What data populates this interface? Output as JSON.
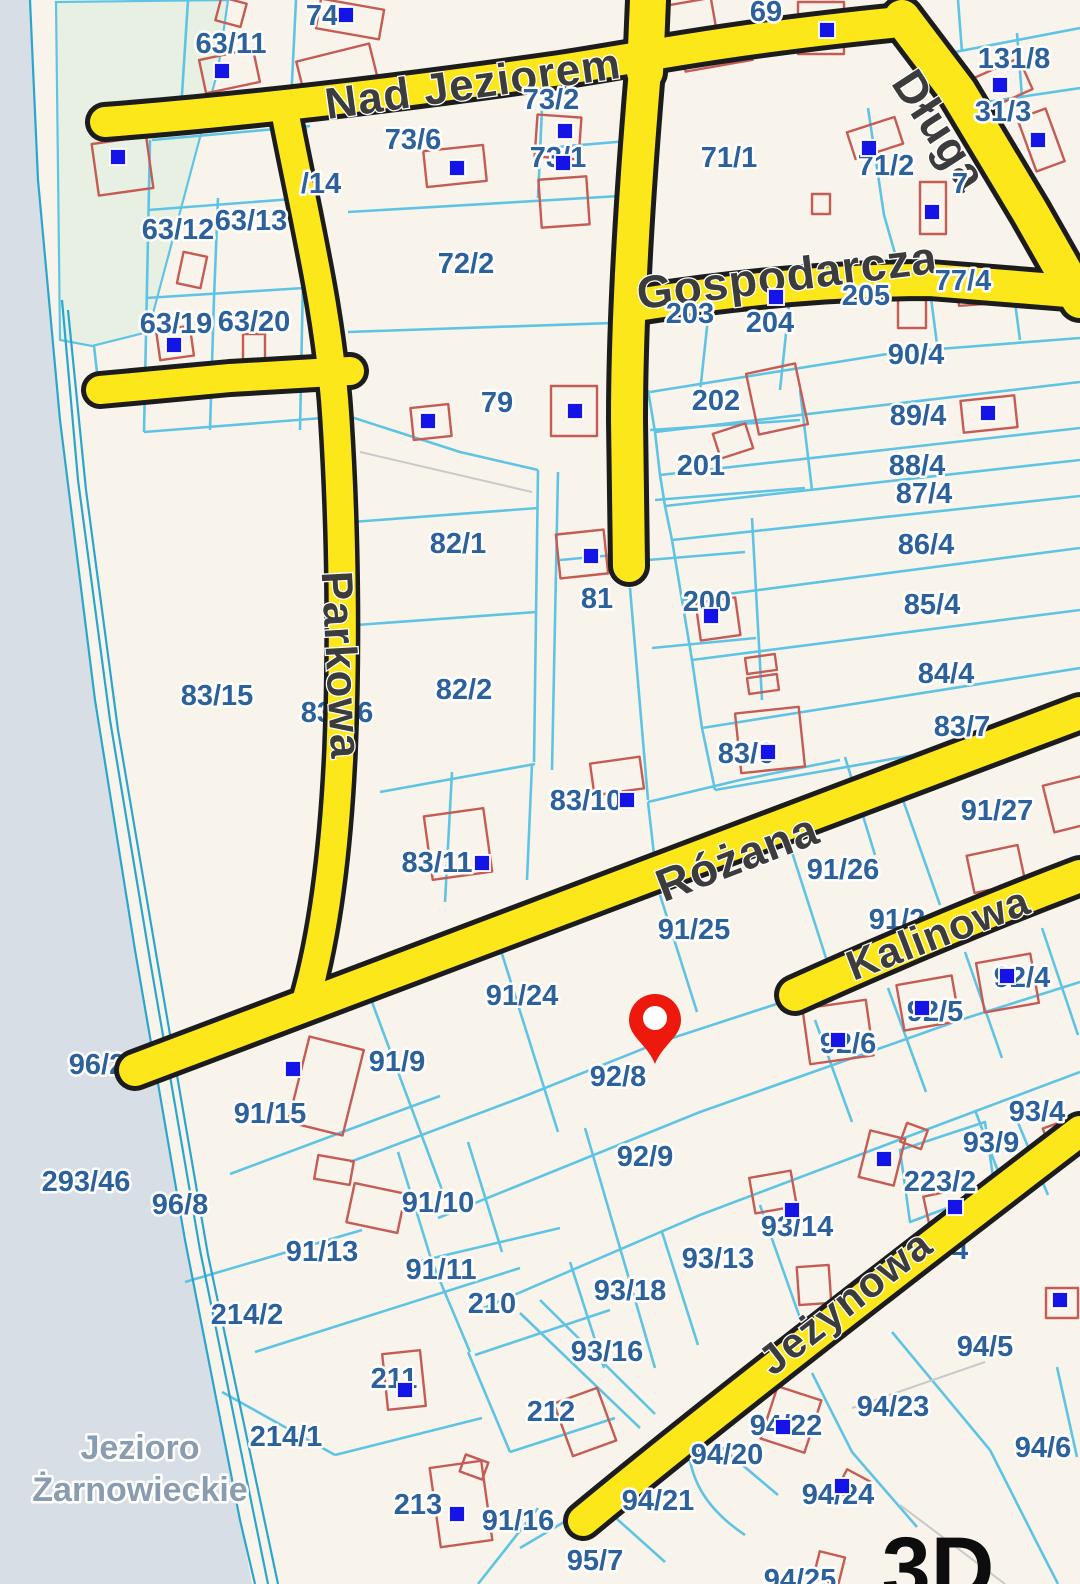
{
  "map": {
    "colors": {
      "land": "#f8f4ec",
      "water": "#d7dee5",
      "green": "#e7f0e3",
      "road_casing": "#1c1c1c",
      "road_fill": "#fce81a",
      "boundary": "#5fc4e4",
      "boundary_strong": "#2aa6cc",
      "building": "#c45c55",
      "marker": "#1414e6",
      "parcel_text": "#2d619b",
      "street_text": "#3c3c3c",
      "water_text": "#8a9cb0",
      "pin": "#ed190d"
    },
    "streets": [
      {
        "name": "Nad Jeziorem",
        "x": 473,
        "y": 84,
        "rotation": -8,
        "size": 44
      },
      {
        "name": "Długa",
        "x": 940,
        "y": 130,
        "rotation": 57,
        "size": 46
      },
      {
        "name": "Gospodarcza",
        "x": 787,
        "y": 275,
        "rotation": -7,
        "size": 46
      },
      {
        "name": "Parkowa",
        "x": 341,
        "y": 665,
        "rotation": 87,
        "size": 44
      },
      {
        "name": "Różana",
        "x": 737,
        "y": 857,
        "rotation": -21,
        "size": 46
      },
      {
        "name": "Kalinowa",
        "x": 938,
        "y": 933,
        "rotation": -21,
        "size": 42
      },
      {
        "name": "Jeżynowa",
        "x": 845,
        "y": 1302,
        "rotation": -38,
        "size": 42
      }
    ],
    "water_label_line1": "Jezioro",
    "water_label_line2": "Żarnowieckie",
    "view3d_label": "3D",
    "pin": {
      "x": 655,
      "y": 1064
    },
    "parcels": [
      {
        "label": "74",
        "x": 322,
        "y": 16
      },
      {
        "label": "69",
        "x": 766,
        "y": 12
      },
      {
        "label": "63/11",
        "x": 231,
        "y": 44
      },
      {
        "label": "73/2",
        "x": 551,
        "y": 100
      },
      {
        "label": "131/8",
        "x": 1014,
        "y": 59
      },
      {
        "label": "31/3",
        "x": 1003,
        "y": 112
      },
      {
        "label": "1",
        "x": 965,
        "y": 77,
        "under": true
      },
      {
        "label": "73/6",
        "x": 413,
        "y": 140
      },
      {
        "label": "73/1",
        "x": 558,
        "y": 158
      },
      {
        "label": "71/1",
        "x": 729,
        "y": 158
      },
      {
        "label": "71/2",
        "x": 886,
        "y": 166
      },
      {
        "label": "7",
        "x": 960,
        "y": 184
      },
      {
        "label": "/14",
        "x": 321,
        "y": 184
      },
      {
        "label": "63/12",
        "x": 178,
        "y": 230
      },
      {
        "label": "63/13",
        "x": 251,
        "y": 221
      },
      {
        "label": "72/2",
        "x": 466,
        "y": 264
      },
      {
        "label": "63/19",
        "x": 176,
        "y": 324
      },
      {
        "label": "63/20",
        "x": 254,
        "y": 322
      },
      {
        "label": "203",
        "x": 690,
        "y": 314
      },
      {
        "label": "204",
        "x": 770,
        "y": 323
      },
      {
        "label": "205",
        "x": 866,
        "y": 296
      },
      {
        "label": "77/4",
        "x": 963,
        "y": 281
      },
      {
        "label": "90/4",
        "x": 916,
        "y": 355
      },
      {
        "label": "79",
        "x": 497,
        "y": 403
      },
      {
        "label": "202",
        "x": 716,
        "y": 401
      },
      {
        "label": "89/4",
        "x": 918,
        "y": 416
      },
      {
        "label": "201",
        "x": 701,
        "y": 466
      },
      {
        "label": "88/4",
        "x": 917,
        "y": 466
      },
      {
        "label": "87/4",
        "x": 924,
        "y": 494
      },
      {
        "label": "82/1",
        "x": 458,
        "y": 544
      },
      {
        "label": "86/4",
        "x": 926,
        "y": 545
      },
      {
        "label": "81",
        "x": 597,
        "y": 599
      },
      {
        "label": "200",
        "x": 707,
        "y": 602
      },
      {
        "label": "85/4",
        "x": 932,
        "y": 605
      },
      {
        "label": "84/4",
        "x": 946,
        "y": 674
      },
      {
        "label": "83/15",
        "x": 217,
        "y": 696
      },
      {
        "label": "83/16",
        "x": 337,
        "y": 713,
        "under": true
      },
      {
        "label": "82/2",
        "x": 464,
        "y": 690
      },
      {
        "label": "83/7",
        "x": 962,
        "y": 727
      },
      {
        "label": "83/6",
        "x": 746,
        "y": 754
      },
      {
        "label": "83/10",
        "x": 586,
        "y": 801
      },
      {
        "label": "91/27",
        "x": 997,
        "y": 811
      },
      {
        "label": "83/11",
        "x": 437,
        "y": 863
      },
      {
        "label": "91/26",
        "x": 843,
        "y": 870
      },
      {
        "label": "91/2",
        "x": 897,
        "y": 920,
        "under": true
      },
      {
        "label": "91/25",
        "x": 694,
        "y": 930
      },
      {
        "label": "91/24",
        "x": 522,
        "y": 996
      },
      {
        "label": "92/4",
        "x": 1022,
        "y": 978
      },
      {
        "label": "96/2",
        "x": 97,
        "y": 1065,
        "under": true
      },
      {
        "label": "92/5",
        "x": 935,
        "y": 1012
      },
      {
        "label": "92/8",
        "x": 618,
        "y": 1077
      },
      {
        "label": "92/6",
        "x": 848,
        "y": 1044
      },
      {
        "label": "91/15",
        "x": 270,
        "y": 1114
      },
      {
        "label": "91/9",
        "x": 397,
        "y": 1062
      },
      {
        "label": "293/46",
        "x": 86,
        "y": 1182
      },
      {
        "label": "96/8",
        "x": 180,
        "y": 1205
      },
      {
        "label": "92/9",
        "x": 645,
        "y": 1157
      },
      {
        "label": "93/4",
        "x": 1037,
        "y": 1112
      },
      {
        "label": "93/9",
        "x": 991,
        "y": 1143
      },
      {
        "label": "223/2",
        "x": 940,
        "y": 1182
      },
      {
        "label": "91/10",
        "x": 438,
        "y": 1203
      },
      {
        "label": "93/14",
        "x": 797,
        "y": 1227
      },
      {
        "label": "91/13",
        "x": 322,
        "y": 1252
      },
      {
        "label": "93/13",
        "x": 718,
        "y": 1259
      },
      {
        "label": "91/11",
        "x": 441,
        "y": 1270
      },
      {
        "label": "210",
        "x": 492,
        "y": 1304
      },
      {
        "label": "214/2",
        "x": 247,
        "y": 1315
      },
      {
        "label": "93/18",
        "x": 630,
        "y": 1291
      },
      {
        "label": "94",
        "x": 952,
        "y": 1250,
        "under": true
      },
      {
        "label": "93/16",
        "x": 607,
        "y": 1352
      },
      {
        "label": "211",
        "x": 394,
        "y": 1379
      },
      {
        "label": "94/5",
        "x": 985,
        "y": 1347
      },
      {
        "label": "212",
        "x": 551,
        "y": 1412
      },
      {
        "label": "94/23",
        "x": 893,
        "y": 1407
      },
      {
        "label": "94/22",
        "x": 786,
        "y": 1426
      },
      {
        "label": "214/1",
        "x": 286,
        "y": 1437
      },
      {
        "label": "94/20",
        "x": 727,
        "y": 1455
      },
      {
        "label": "94/6",
        "x": 1043,
        "y": 1448
      },
      {
        "label": "213",
        "x": 418,
        "y": 1505
      },
      {
        "label": "91/16",
        "x": 518,
        "y": 1521,
        "under": true
      },
      {
        "label": "94/21",
        "x": 658,
        "y": 1501
      },
      {
        "label": "94/24",
        "x": 838,
        "y": 1495
      },
      {
        "label": "95/7",
        "x": 595,
        "y": 1561
      },
      {
        "label": "94/25",
        "x": 800,
        "y": 1580
      }
    ],
    "buildings": [
      {
        "x": 318,
        "y": 4,
        "w": 64,
        "h": 30,
        "r": 10
      },
      {
        "x": 218,
        "y": 0,
        "w": 26,
        "h": 24,
        "r": 15
      },
      {
        "x": 202,
        "y": 54,
        "w": 55,
        "h": 34,
        "r": -12
      },
      {
        "x": 640,
        "y": 4,
        "w": 75,
        "h": 42,
        "r": -10
      },
      {
        "x": 682,
        "y": 30,
        "w": 68,
        "h": 36,
        "r": -10
      },
      {
        "x": 798,
        "y": 2,
        "w": 46,
        "h": 52,
        "r": 0
      },
      {
        "x": 300,
        "y": 52,
        "w": 75,
        "h": 40,
        "r": -14
      },
      {
        "x": 95,
        "y": 140,
        "w": 55,
        "h": 52,
        "r": -8
      },
      {
        "x": 425,
        "y": 148,
        "w": 60,
        "h": 36,
        "r": -6
      },
      {
        "x": 536,
        "y": 116,
        "w": 44,
        "h": 42,
        "r": 4
      },
      {
        "x": 540,
        "y": 178,
        "w": 48,
        "h": 48,
        "r": -4
      },
      {
        "x": 850,
        "y": 124,
        "w": 50,
        "h": 28,
        "r": -18
      },
      {
        "x": 972,
        "y": 68,
        "w": 56,
        "h": 34,
        "r": -24
      },
      {
        "x": 1026,
        "y": 112,
        "w": 30,
        "h": 56,
        "r": -20
      },
      {
        "x": 920,
        "y": 182,
        "w": 26,
        "h": 52,
        "r": 0
      },
      {
        "x": 812,
        "y": 194,
        "w": 18,
        "h": 20,
        "r": 0
      },
      {
        "x": 644,
        "y": 302,
        "w": 24,
        "h": 20,
        "r": -8
      },
      {
        "x": 898,
        "y": 292,
        "w": 28,
        "h": 36,
        "r": 0
      },
      {
        "x": 958,
        "y": 276,
        "w": 54,
        "h": 28,
        "r": -4
      },
      {
        "x": 752,
        "y": 368,
        "w": 50,
        "h": 62,
        "r": -12
      },
      {
        "x": 716,
        "y": 428,
        "w": 34,
        "h": 26,
        "r": -18
      },
      {
        "x": 962,
        "y": 398,
        "w": 54,
        "h": 32,
        "r": -6
      },
      {
        "x": 180,
        "y": 254,
        "w": 24,
        "h": 32,
        "r": 12
      },
      {
        "x": 158,
        "y": 328,
        "w": 34,
        "h": 30,
        "r": -8
      },
      {
        "x": 243,
        "y": 334,
        "w": 22,
        "h": 28,
        "r": 0
      },
      {
        "x": 412,
        "y": 406,
        "w": 38,
        "h": 32,
        "r": -6
      },
      {
        "x": 551,
        "y": 386,
        "w": 46,
        "h": 50,
        "r": 0
      },
      {
        "x": 558,
        "y": 532,
        "w": 48,
        "h": 44,
        "r": -6
      },
      {
        "x": 698,
        "y": 600,
        "w": 40,
        "h": 38,
        "r": -8
      },
      {
        "x": 746,
        "y": 656,
        "w": 30,
        "h": 16,
        "r": -8
      },
      {
        "x": 748,
        "y": 676,
        "w": 30,
        "h": 16,
        "r": -8
      },
      {
        "x": 738,
        "y": 710,
        "w": 64,
        "h": 60,
        "r": -6
      },
      {
        "x": 592,
        "y": 760,
        "w": 50,
        "h": 32,
        "r": -8
      },
      {
        "x": 428,
        "y": 812,
        "w": 60,
        "h": 64,
        "r": -8
      },
      {
        "x": 1048,
        "y": 780,
        "w": 42,
        "h": 48,
        "r": -14
      },
      {
        "x": 970,
        "y": 850,
        "w": 52,
        "h": 38,
        "r": -12
      },
      {
        "x": 980,
        "y": 958,
        "w": 55,
        "h": 50,
        "r": -10
      },
      {
        "x": 900,
        "y": 980,
        "w": 56,
        "h": 46,
        "r": -10
      },
      {
        "x": 806,
        "y": 1004,
        "w": 64,
        "h": 56,
        "r": -8
      },
      {
        "x": 298,
        "y": 1042,
        "w": 56,
        "h": 88,
        "r": 14
      },
      {
        "x": 316,
        "y": 1158,
        "w": 36,
        "h": 24,
        "r": 10
      },
      {
        "x": 350,
        "y": 1188,
        "w": 52,
        "h": 40,
        "r": 12
      },
      {
        "x": 752,
        "y": 1174,
        "w": 42,
        "h": 36,
        "r": -10
      },
      {
        "x": 864,
        "y": 1134,
        "w": 36,
        "h": 48,
        "r": 14
      },
      {
        "x": 903,
        "y": 1126,
        "w": 22,
        "h": 20,
        "r": 20
      },
      {
        "x": 926,
        "y": 1192,
        "w": 42,
        "h": 30,
        "r": -12
      },
      {
        "x": 1048,
        "y": 1122,
        "w": 32,
        "h": 36,
        "r": -20
      },
      {
        "x": 798,
        "y": 1266,
        "w": 32,
        "h": 38,
        "r": -4
      },
      {
        "x": 768,
        "y": 1392,
        "w": 46,
        "h": 55,
        "r": 18
      },
      {
        "x": 840,
        "y": 1474,
        "w": 26,
        "h": 24,
        "r": 28
      },
      {
        "x": 816,
        "y": 1554,
        "w": 26,
        "h": 28,
        "r": 14
      },
      {
        "x": 435,
        "y": 1464,
        "w": 52,
        "h": 80,
        "r": -8
      },
      {
        "x": 462,
        "y": 1458,
        "w": 24,
        "h": 18,
        "r": 20
      },
      {
        "x": 385,
        "y": 1352,
        "w": 38,
        "h": 56,
        "r": -6
      },
      {
        "x": 562,
        "y": 1394,
        "w": 46,
        "h": 56,
        "r": -20
      },
      {
        "x": 1046,
        "y": 1288,
        "w": 32,
        "h": 30,
        "r": 0
      }
    ],
    "markers": [
      {
        "x": 346,
        "y": 15
      },
      {
        "x": 222,
        "y": 71
      },
      {
        "x": 118,
        "y": 157
      },
      {
        "x": 457,
        "y": 168
      },
      {
        "x": 565,
        "y": 131
      },
      {
        "x": 563,
        "y": 163
      },
      {
        "x": 827,
        "y": 30
      },
      {
        "x": 869,
        "y": 148
      },
      {
        "x": 1000,
        "y": 85
      },
      {
        "x": 1038,
        "y": 140
      },
      {
        "x": 932,
        "y": 212
      },
      {
        "x": 776,
        "y": 297
      },
      {
        "x": 988,
        "y": 413
      },
      {
        "x": 428,
        "y": 421
      },
      {
        "x": 575,
        "y": 411
      },
      {
        "x": 591,
        "y": 556
      },
      {
        "x": 711,
        "y": 616
      },
      {
        "x": 768,
        "y": 752
      },
      {
        "x": 627,
        "y": 800
      },
      {
        "x": 482,
        "y": 863
      },
      {
        "x": 174,
        "y": 345
      },
      {
        "x": 293,
        "y": 1069
      },
      {
        "x": 1007,
        "y": 976
      },
      {
        "x": 922,
        "y": 1008
      },
      {
        "x": 838,
        "y": 1040
      },
      {
        "x": 792,
        "y": 1210
      },
      {
        "x": 884,
        "y": 1159
      },
      {
        "x": 955,
        "y": 1207
      },
      {
        "x": 783,
        "y": 1427
      },
      {
        "x": 842,
        "y": 1486
      },
      {
        "x": 457,
        "y": 1514
      },
      {
        "x": 405,
        "y": 1390
      },
      {
        "x": 1060,
        "y": 1300
      }
    ]
  }
}
